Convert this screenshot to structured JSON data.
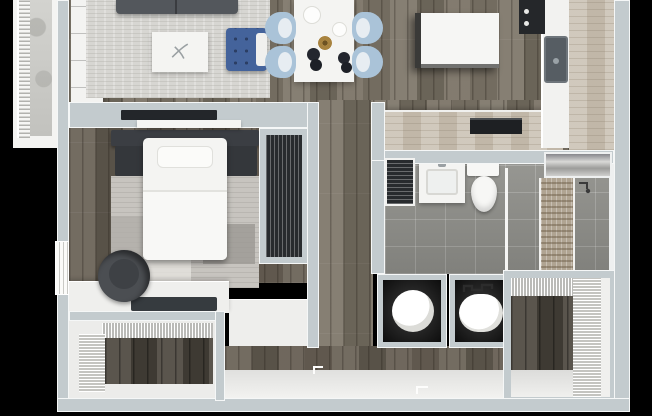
{
  "meta": {
    "description": "3D top-down rendered floor plan of a one-bedroom, one-bath apartment with balcony",
    "canvas_width": 652,
    "canvas_height": 416,
    "no_visible_text": true
  },
  "palette": {
    "background": "#000000",
    "wall_fill": "#c3cbce",
    "wall_edge": "#f5f7f7",
    "floor_wood": "#7c7467",
    "floor_wood_dark": "#675f54",
    "closet_wood": "#4e4840",
    "counter_wood": "#c9c0b2",
    "rug_living": "#d7d6d2",
    "rug_bedroom": "#c7c4bf",
    "sofa_gray": "#53575c",
    "accent_blue": "#44639b",
    "dining_chair_blue": "#aac3d8",
    "appliance_dark": "#25272a",
    "bath_tile": "#8f8f8a",
    "mosaic_tile": "#b0a492",
    "metal": "#a6a6a4",
    "white_furniture": "#f4f4f2",
    "concrete": "#cdcdc9",
    "louver_dark": "#282b2e"
  },
  "rooms": {
    "living": {
      "label": "Living room"
    },
    "dining": {
      "label": "Dining area"
    },
    "kitchen": {
      "label": "Kitchen"
    },
    "bedroom": {
      "label": "Bedroom"
    },
    "bathroom": {
      "label": "Bathroom"
    },
    "hallway": {
      "label": "Hallway"
    },
    "entry": {
      "label": "Entry hall"
    },
    "laundry": {
      "label": "Laundry closets"
    },
    "closet_bedroom": {
      "label": "Bedroom closet"
    },
    "closet_left": {
      "label": "Walk-in closet (bedroom side)"
    },
    "closet_right": {
      "label": "Walk-in closet (entry side)"
    },
    "balcony": {
      "label": "Balcony"
    }
  },
  "furniture": {
    "sofa": {
      "label": "Sofa"
    },
    "rug_living": {
      "label": "Living room rug"
    },
    "coffee_table": {
      "label": "Coffee table"
    },
    "accent_chair": {
      "label": "Blue tufted accent chair"
    },
    "media_console": {
      "label": "Media console"
    },
    "tv": {
      "label": "Wall-mounted TV"
    },
    "dining_table": {
      "label": "Dining table"
    },
    "dining_chair": {
      "label": "Dining chair"
    },
    "island": {
      "label": "Kitchen island"
    },
    "range": {
      "label": "Range"
    },
    "sink": {
      "label": "Kitchen sink"
    },
    "counter": {
      "label": "Kitchen counter"
    },
    "dishwasher": {
      "label": "Dishwasher"
    },
    "bed": {
      "label": "Bed"
    },
    "headboard": {
      "label": "Headboard"
    },
    "nightstand": {
      "label": "Nightstand"
    },
    "rug_bedroom": {
      "label": "Bedroom rug"
    },
    "desk": {
      "label": "Desk"
    },
    "desk_chair": {
      "label": "Desk chair"
    },
    "window": {
      "label": "Bedroom window"
    },
    "vanity": {
      "label": "Bathroom vanity"
    },
    "toilet": {
      "label": "Toilet"
    },
    "shower": {
      "label": "Walk-in shower"
    },
    "metal_shelf": {
      "label": "Metal shelf"
    },
    "washer": {
      "label": "Washer"
    },
    "dryer": {
      "label": "Dryer"
    },
    "wire_shelving": {
      "label": "Wire shelving"
    },
    "louver_door": {
      "label": "Louvered utility door"
    },
    "entry_door": {
      "label": "Entry door"
    },
    "railing": {
      "label": "Balcony railing"
    }
  }
}
